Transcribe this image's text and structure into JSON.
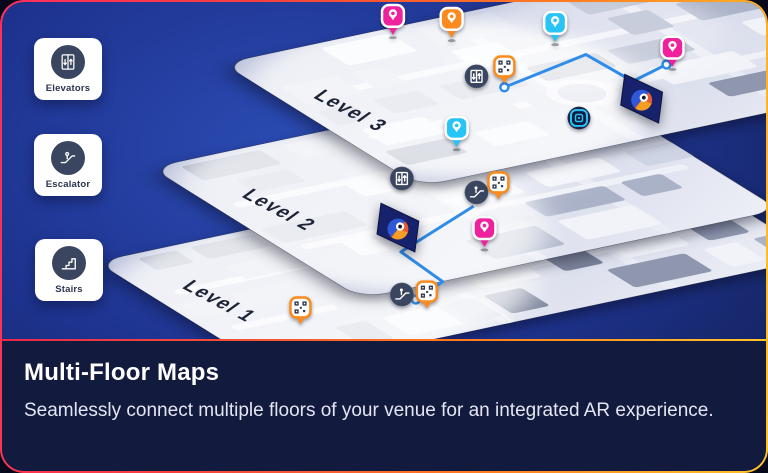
{
  "card": {
    "title": "Multi-Floor Maps",
    "description": "Seamlessly connect multiple floors of your venue for an integrated AR experience."
  },
  "legend": [
    {
      "label": "Elevators",
      "icon": "elevator-icon"
    },
    {
      "label": "Escalator",
      "icon": "escalator-icon"
    },
    {
      "label": "Stairs",
      "icon": "stairs-icon"
    }
  ],
  "map": {
    "levels": [
      {
        "label": "Level 3",
        "label_x": 312,
        "label_y": 96,
        "plane": {
          "ox": 222,
          "oy": 62,
          "w": 520,
          "h": 310
        }
      },
      {
        "label": "Level 2",
        "label_x": 240,
        "label_y": 196,
        "plane": {
          "ox": 150,
          "oy": 167,
          "w": 430,
          "h": 330
        }
      },
      {
        "label": "Level 1",
        "label_x": 180,
        "label_y": 288,
        "plane": {
          "ox": 95,
          "oy": 262,
          "w": 560,
          "h": 280
        }
      }
    ],
    "routes": [
      {
        "points": [
          [
            505,
            86
          ],
          [
            587,
            53
          ],
          [
            634,
            80
          ],
          [
            668,
            63
          ]
        ],
        "endpoints": [
          [
            505,
            86
          ],
          [
            668,
            63
          ]
        ]
      },
      {
        "points": [
          [
            474,
            206
          ],
          [
            401,
            252
          ],
          [
            443,
            282
          ],
          [
            416,
            300
          ]
        ],
        "endpoints": [
          [
            416,
            300
          ]
        ]
      }
    ],
    "ar_panels": [
      {
        "x": 626,
        "y": 73
      },
      {
        "x": 381,
        "y": 203
      }
    ],
    "markers": [
      {
        "type": "pin",
        "color": "pink",
        "x": 393,
        "y": 34
      },
      {
        "type": "pin",
        "color": "orange",
        "x": 452,
        "y": 37
      },
      {
        "type": "pin",
        "color": "cyan",
        "x": 556,
        "y": 41
      },
      {
        "type": "pin",
        "color": "cyan",
        "x": 457,
        "y": 147
      },
      {
        "type": "pin",
        "color": "pink",
        "x": 674,
        "y": 66
      },
      {
        "type": "pin",
        "color": "pink",
        "x": 485,
        "y": 248
      },
      {
        "type": "qr",
        "x": 505,
        "y": 83
      },
      {
        "type": "qr",
        "x": 499,
        "y": 200
      },
      {
        "type": "qr",
        "x": 427,
        "y": 310
      },
      {
        "type": "qr",
        "x": 300,
        "y": 326
      },
      {
        "type": "beacon",
        "x": 580,
        "y": 117
      },
      {
        "type": "elevator",
        "x": 477,
        "y": 75
      },
      {
        "type": "elevator",
        "x": 402,
        "y": 178
      },
      {
        "type": "escalator",
        "x": 477,
        "y": 192
      },
      {
        "type": "escalator",
        "x": 402,
        "y": 295
      }
    ]
  },
  "colors": {
    "pin_pink": "#f0219c",
    "pin_orange": "#fb8b1e",
    "pin_cyan": "#27c4f5",
    "route_blue": "#2f8ce8",
    "marker_circle_navy": "#3a4660",
    "panel_navy": "#121a3d",
    "border_pink": "#ff2d5e",
    "border_red": "#f4403c",
    "border_orange": "#ff7f1f",
    "border_yellow": "#ffc42a",
    "plane_base": "#b9c0da",
    "plane_light": "#eef0f7",
    "ar_panel_navy": "#16226b"
  }
}
